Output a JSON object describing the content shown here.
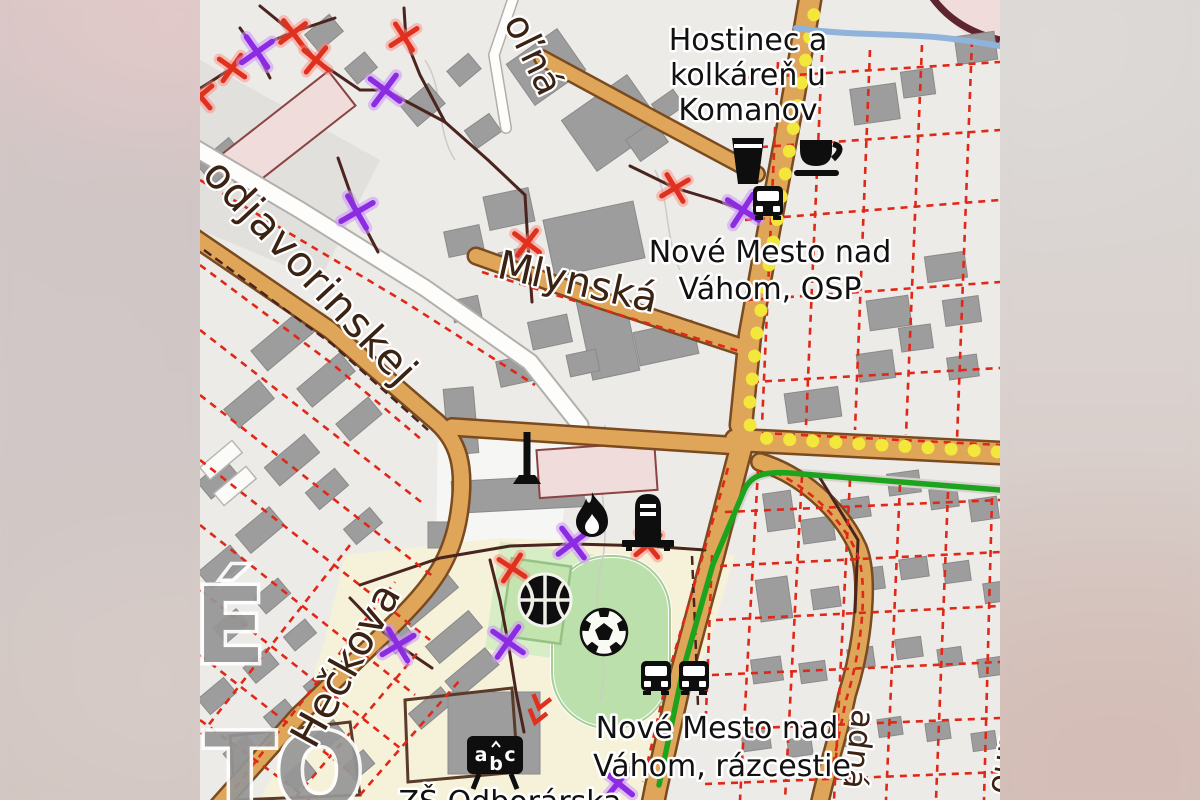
{
  "palette": {
    "land": "#ECEBE7",
    "building": "#9D9D9D",
    "building_edge": "#8A8A8A",
    "road_fill": "#DFA558",
    "road_casing": "#7A4A20",
    "minor_road_fill": "#FDFDFB",
    "minor_road_casing": "#B3AFAA",
    "path_brown": "#4A241E",
    "parcel_red": "#E02818",
    "route_yellow": "#F2E73A",
    "route_green": "#1EA31E",
    "river_blue": "#8FB3DA",
    "pink_fill": "#F1DCDC",
    "pink_edge": "#8A4444",
    "school_ground": "#F6F2D9",
    "sport_zone": "#D7EDC6",
    "sport_field": "#BCE0AB",
    "sport_edge": "#95C285",
    "label_black": "#111111",
    "street_brown": "#3B2314",
    "city_gray": "#969696",
    "marker_red": "#E0301E",
    "marker_purple": "#8B2BE2",
    "icon_black": "#0E0E0E",
    "service_gray": "#D5D3CE",
    "contour_gray": "#CCCBC6"
  },
  "labels": {
    "poi": {
      "hostinec": {
        "line1": "Hostinec a",
        "line2": "kolkáreň u",
        "line3": "Komanov"
      },
      "osp": {
        "line1": "Nové Mesto nad",
        "line2": "Váhom, OSP"
      },
      "razcestie": {
        "line1": "Nové Mesto nad",
        "line2": "Váhom, rázcestie"
      },
      "school_clipped": "ZŠ Odborárska"
    },
    "streets": {
      "olna": "oľná",
      "mlynska": "Mlynská",
      "podjavorinskej": "odjavorinskej",
      "heckova": "Hečkova",
      "zahradna_fragment": "adná",
      "right_edge_fragment": "tino"
    },
    "city_fragments": {
      "f1": "É",
      "f2": "TO"
    },
    "school_icon_letters": {
      "a": "a",
      "b": "b",
      "c": "c"
    }
  }
}
